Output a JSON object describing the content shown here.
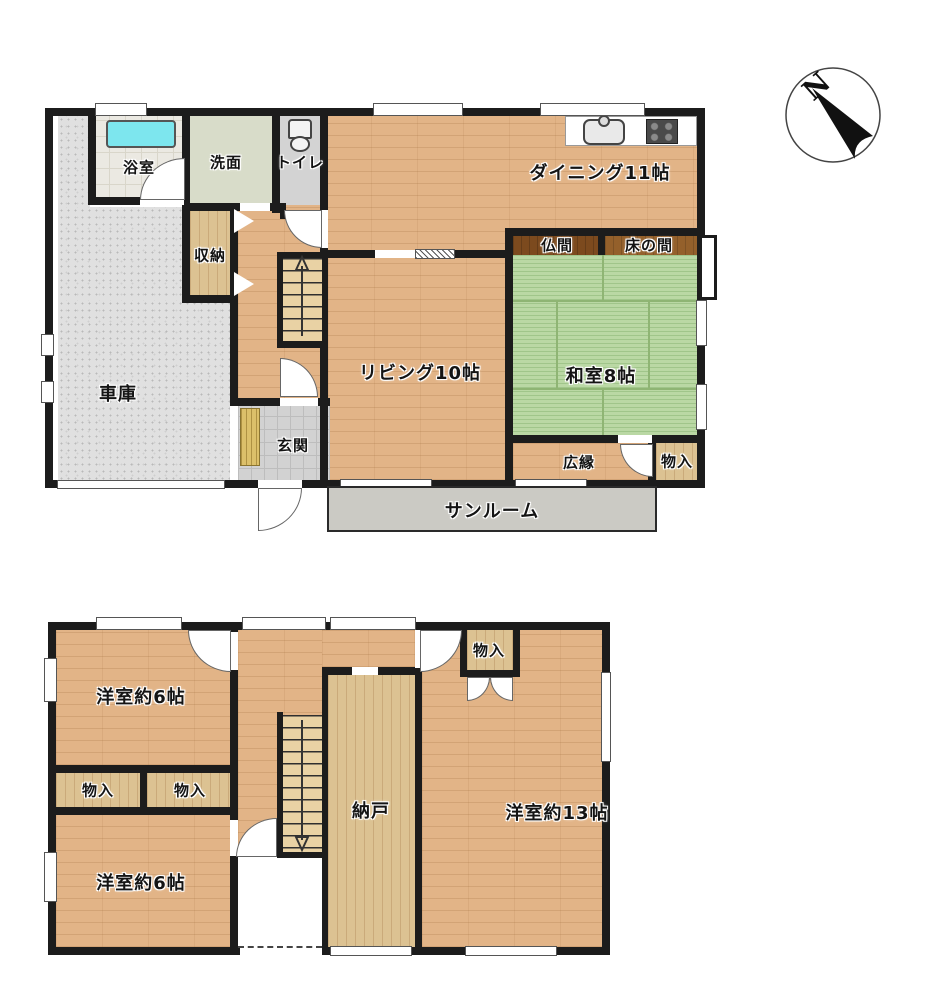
{
  "compass": {
    "north": "N"
  },
  "f1": {
    "bath": "浴室",
    "wash": "洗面",
    "toilet": "トイレ",
    "storage": "収納",
    "dining": "ダイニング11帖",
    "butsuma": "仏間",
    "tokonoma": "床の間",
    "washitsu": "和室8帖",
    "living": "リビング10帖",
    "garage": "車庫",
    "genkan": "玄関",
    "hiroen": "広縁",
    "monoire": "物入",
    "sunroom": "サンルーム"
  },
  "f2": {
    "west6_top": "洋室約6帖",
    "closet1": "物入",
    "closet2": "物入",
    "west6_bottom": "洋室約6帖",
    "nando": "納戸",
    "closet3": "物入",
    "west13": "洋室約13帖"
  }
}
